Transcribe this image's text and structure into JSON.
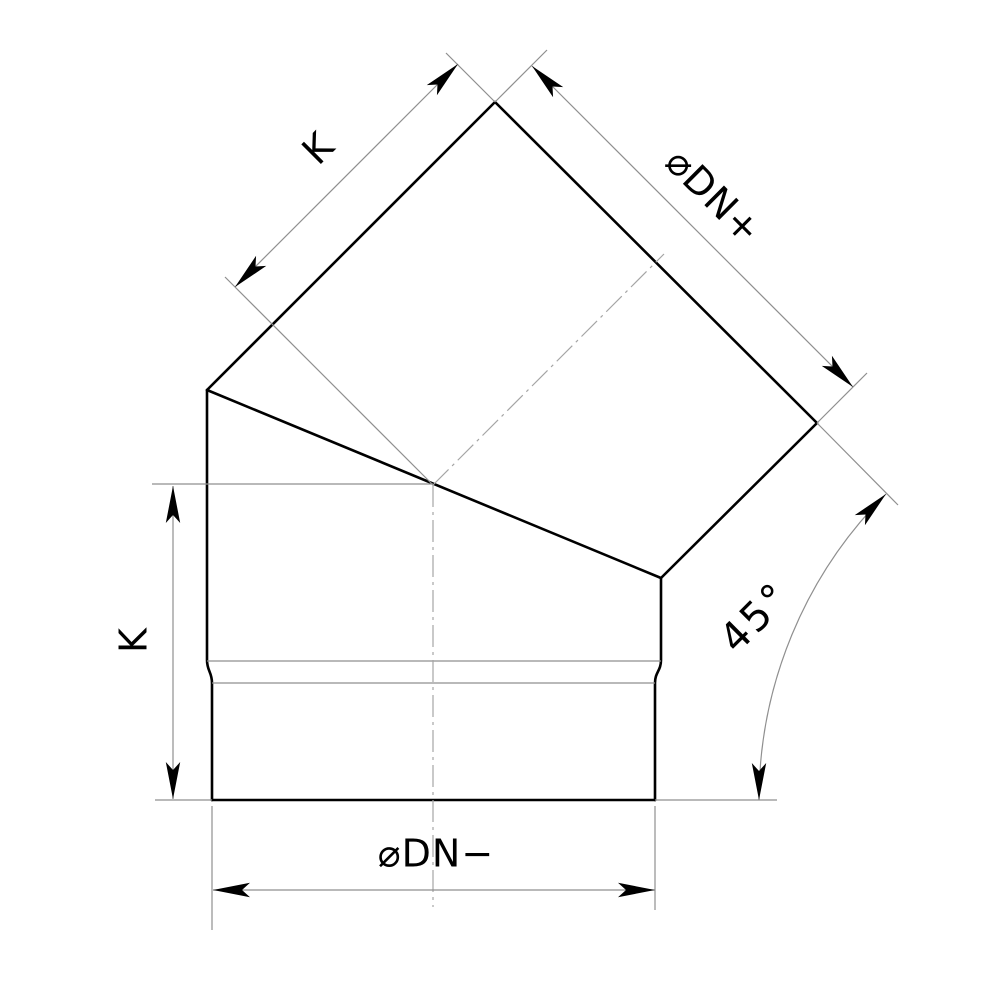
{
  "diagram": {
    "type": "technical-drawing",
    "labels": {
      "k_slant": "K",
      "k_vertical": "K",
      "dn_plus": "⌀DN+",
      "dn_minus": "⌀DN−",
      "angle": "45°"
    },
    "colors": {
      "outline": "#000000",
      "dimension_line": "#8f8f8f",
      "centerline": "#a5a5a5",
      "text": "#000000",
      "background": "#ffffff"
    }
  }
}
